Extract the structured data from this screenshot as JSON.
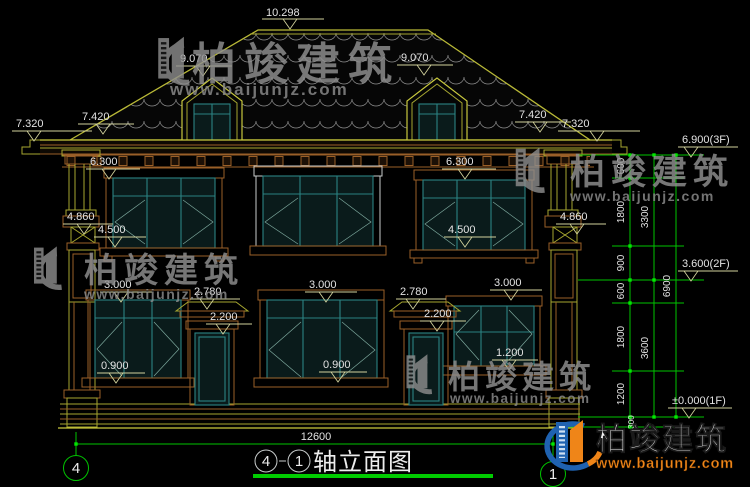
{
  "drawing": {
    "levels": {
      "ridge": "10.298",
      "roof_mid": "9.070",
      "eave_top": "7.420",
      "cornice": "7.320",
      "f2_window_top": "6.300",
      "belt": "4.860",
      "f2_window_sill": "4.500",
      "f1_window_top": "3.000",
      "door_canopy": "2.780",
      "door_top": "2.200",
      "f1_window_sill": "0.900",
      "f1_window_sill_high": "1.200",
      "floor3": "6.900(3F)",
      "floor2": "3.600(2F)",
      "floor1": "±0.000(1F)"
    },
    "dims": {
      "v1": "600",
      "v2": "1800",
      "v3": "900",
      "v4": "600",
      "v5": "1800",
      "v6": "1200",
      "v7": "300",
      "sub1": "3300",
      "sub2": "3600",
      "total_height": "6900",
      "total_width": "12600"
    },
    "axes": {
      "left": "4",
      "right": "1"
    },
    "title": {
      "axis_from": "4",
      "axis_to": "1",
      "text": "轴立面图"
    }
  },
  "brand": {
    "name": "柏竣建筑",
    "url": "www.baijunjz.com"
  }
}
